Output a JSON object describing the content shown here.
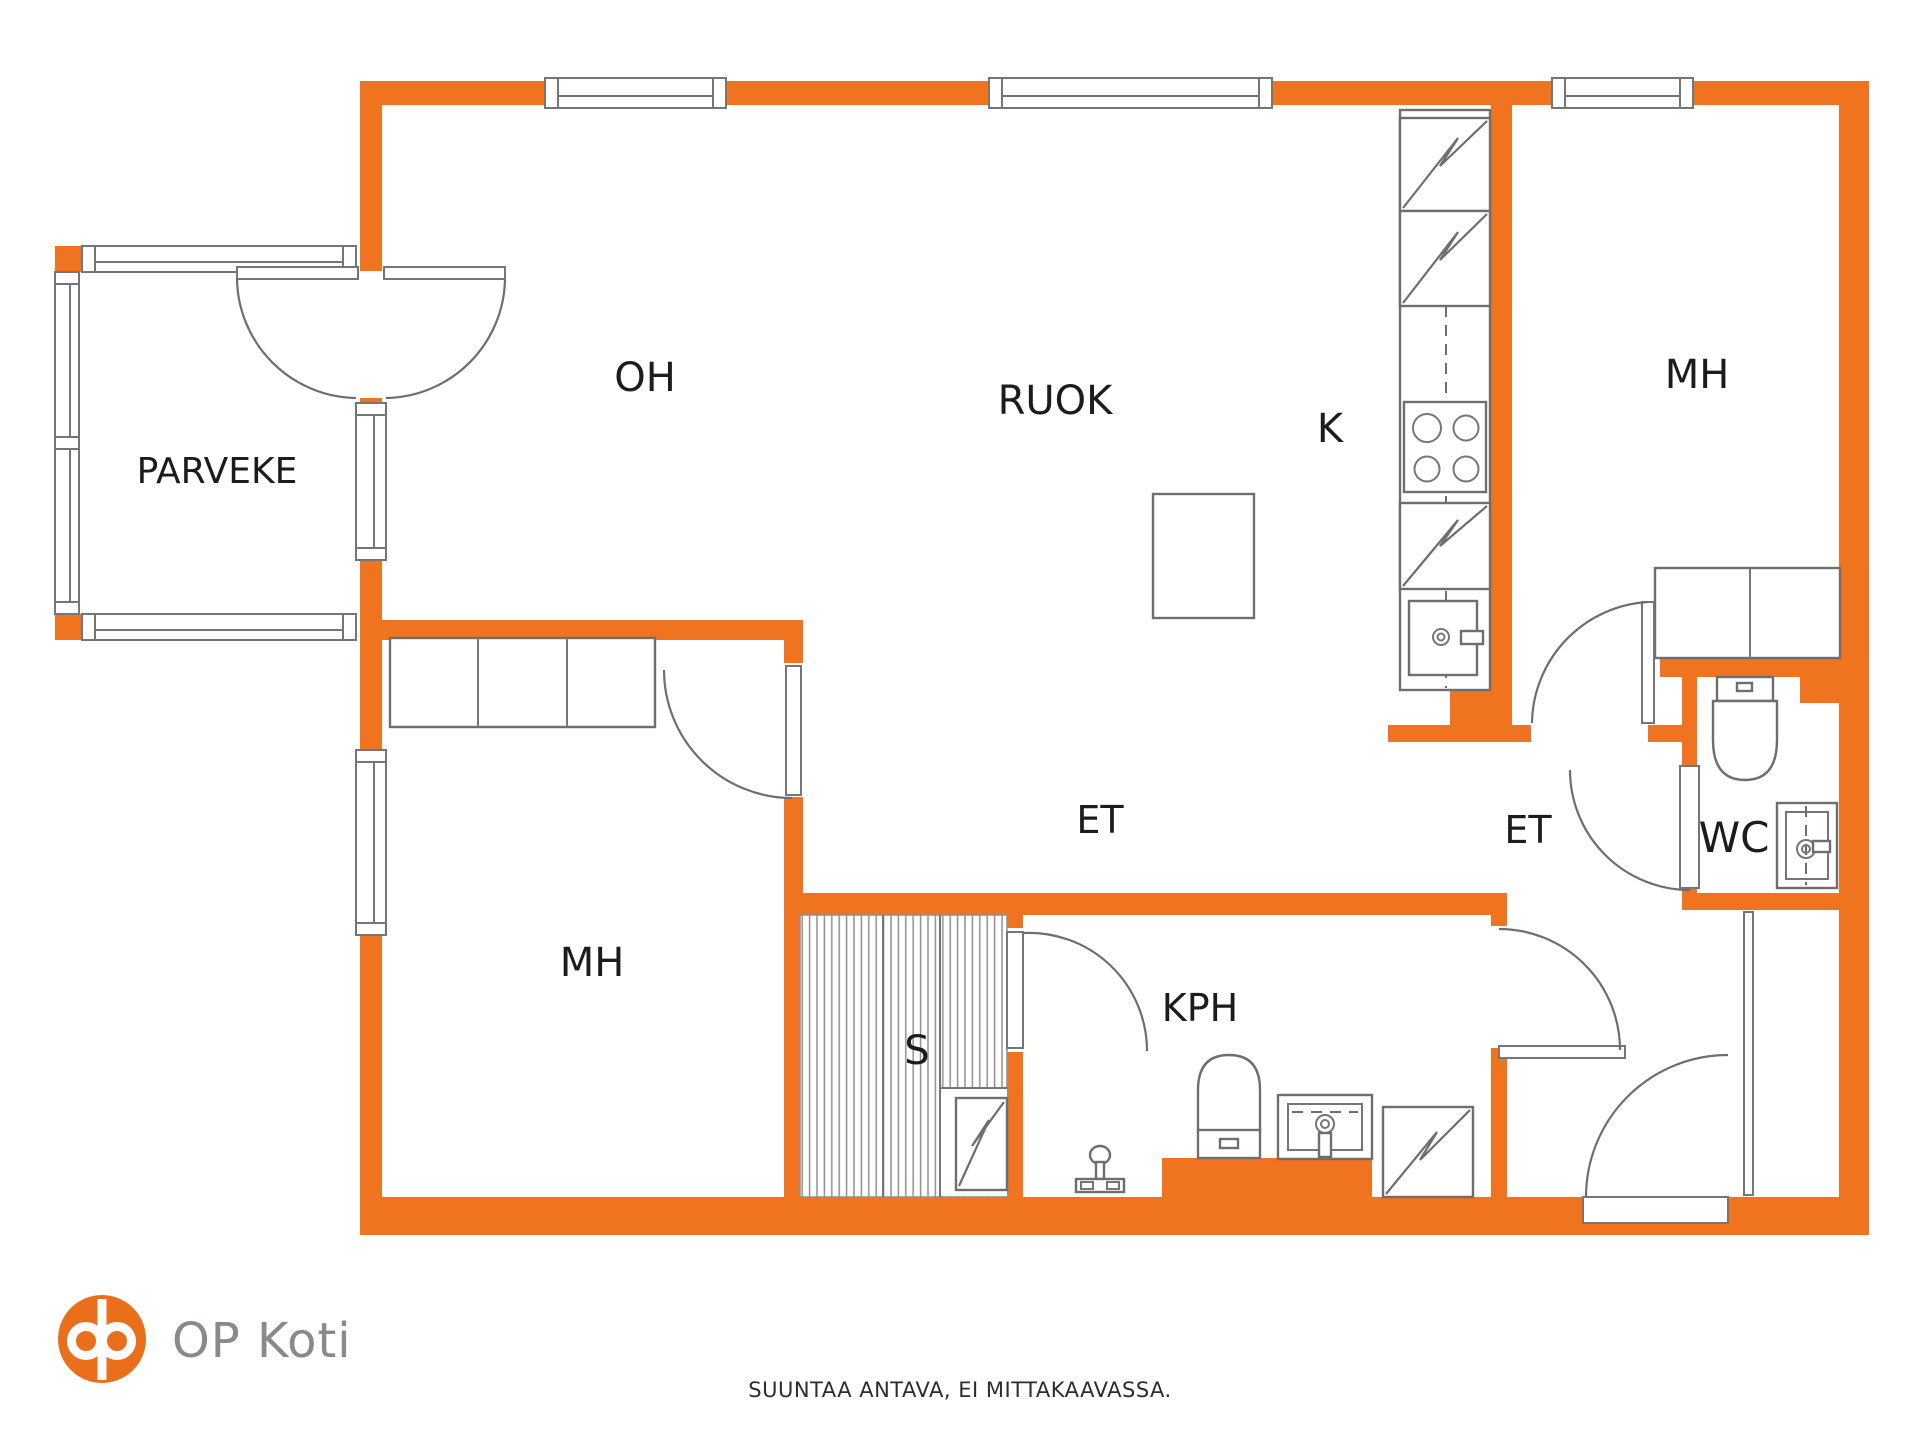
{
  "floorplan": {
    "rooms": {
      "parveke": {
        "label": "PARVEKE"
      },
      "oh": {
        "label": "OH"
      },
      "ruok": {
        "label": "RUOK"
      },
      "k": {
        "label": "K"
      },
      "mh_top": {
        "label": "MH"
      },
      "mh_bottom": {
        "label": "MH"
      },
      "et_left": {
        "label": "ET"
      },
      "et_right": {
        "label": "ET"
      },
      "kph": {
        "label": "KPH"
      },
      "sauna": {
        "label": "S"
      },
      "wc": {
        "label": "WC"
      }
    },
    "colors": {
      "wall_orange": "#F0741F",
      "logo_orange": "#EA6F1D",
      "line_gray": "#767676",
      "label_text": "#1C1C1C"
    }
  },
  "branding": {
    "logo_text": "OP Koti"
  },
  "footer": {
    "disclaimer": "SUUNTAA ANTAVA, EI MITTAKAAVASSA."
  }
}
